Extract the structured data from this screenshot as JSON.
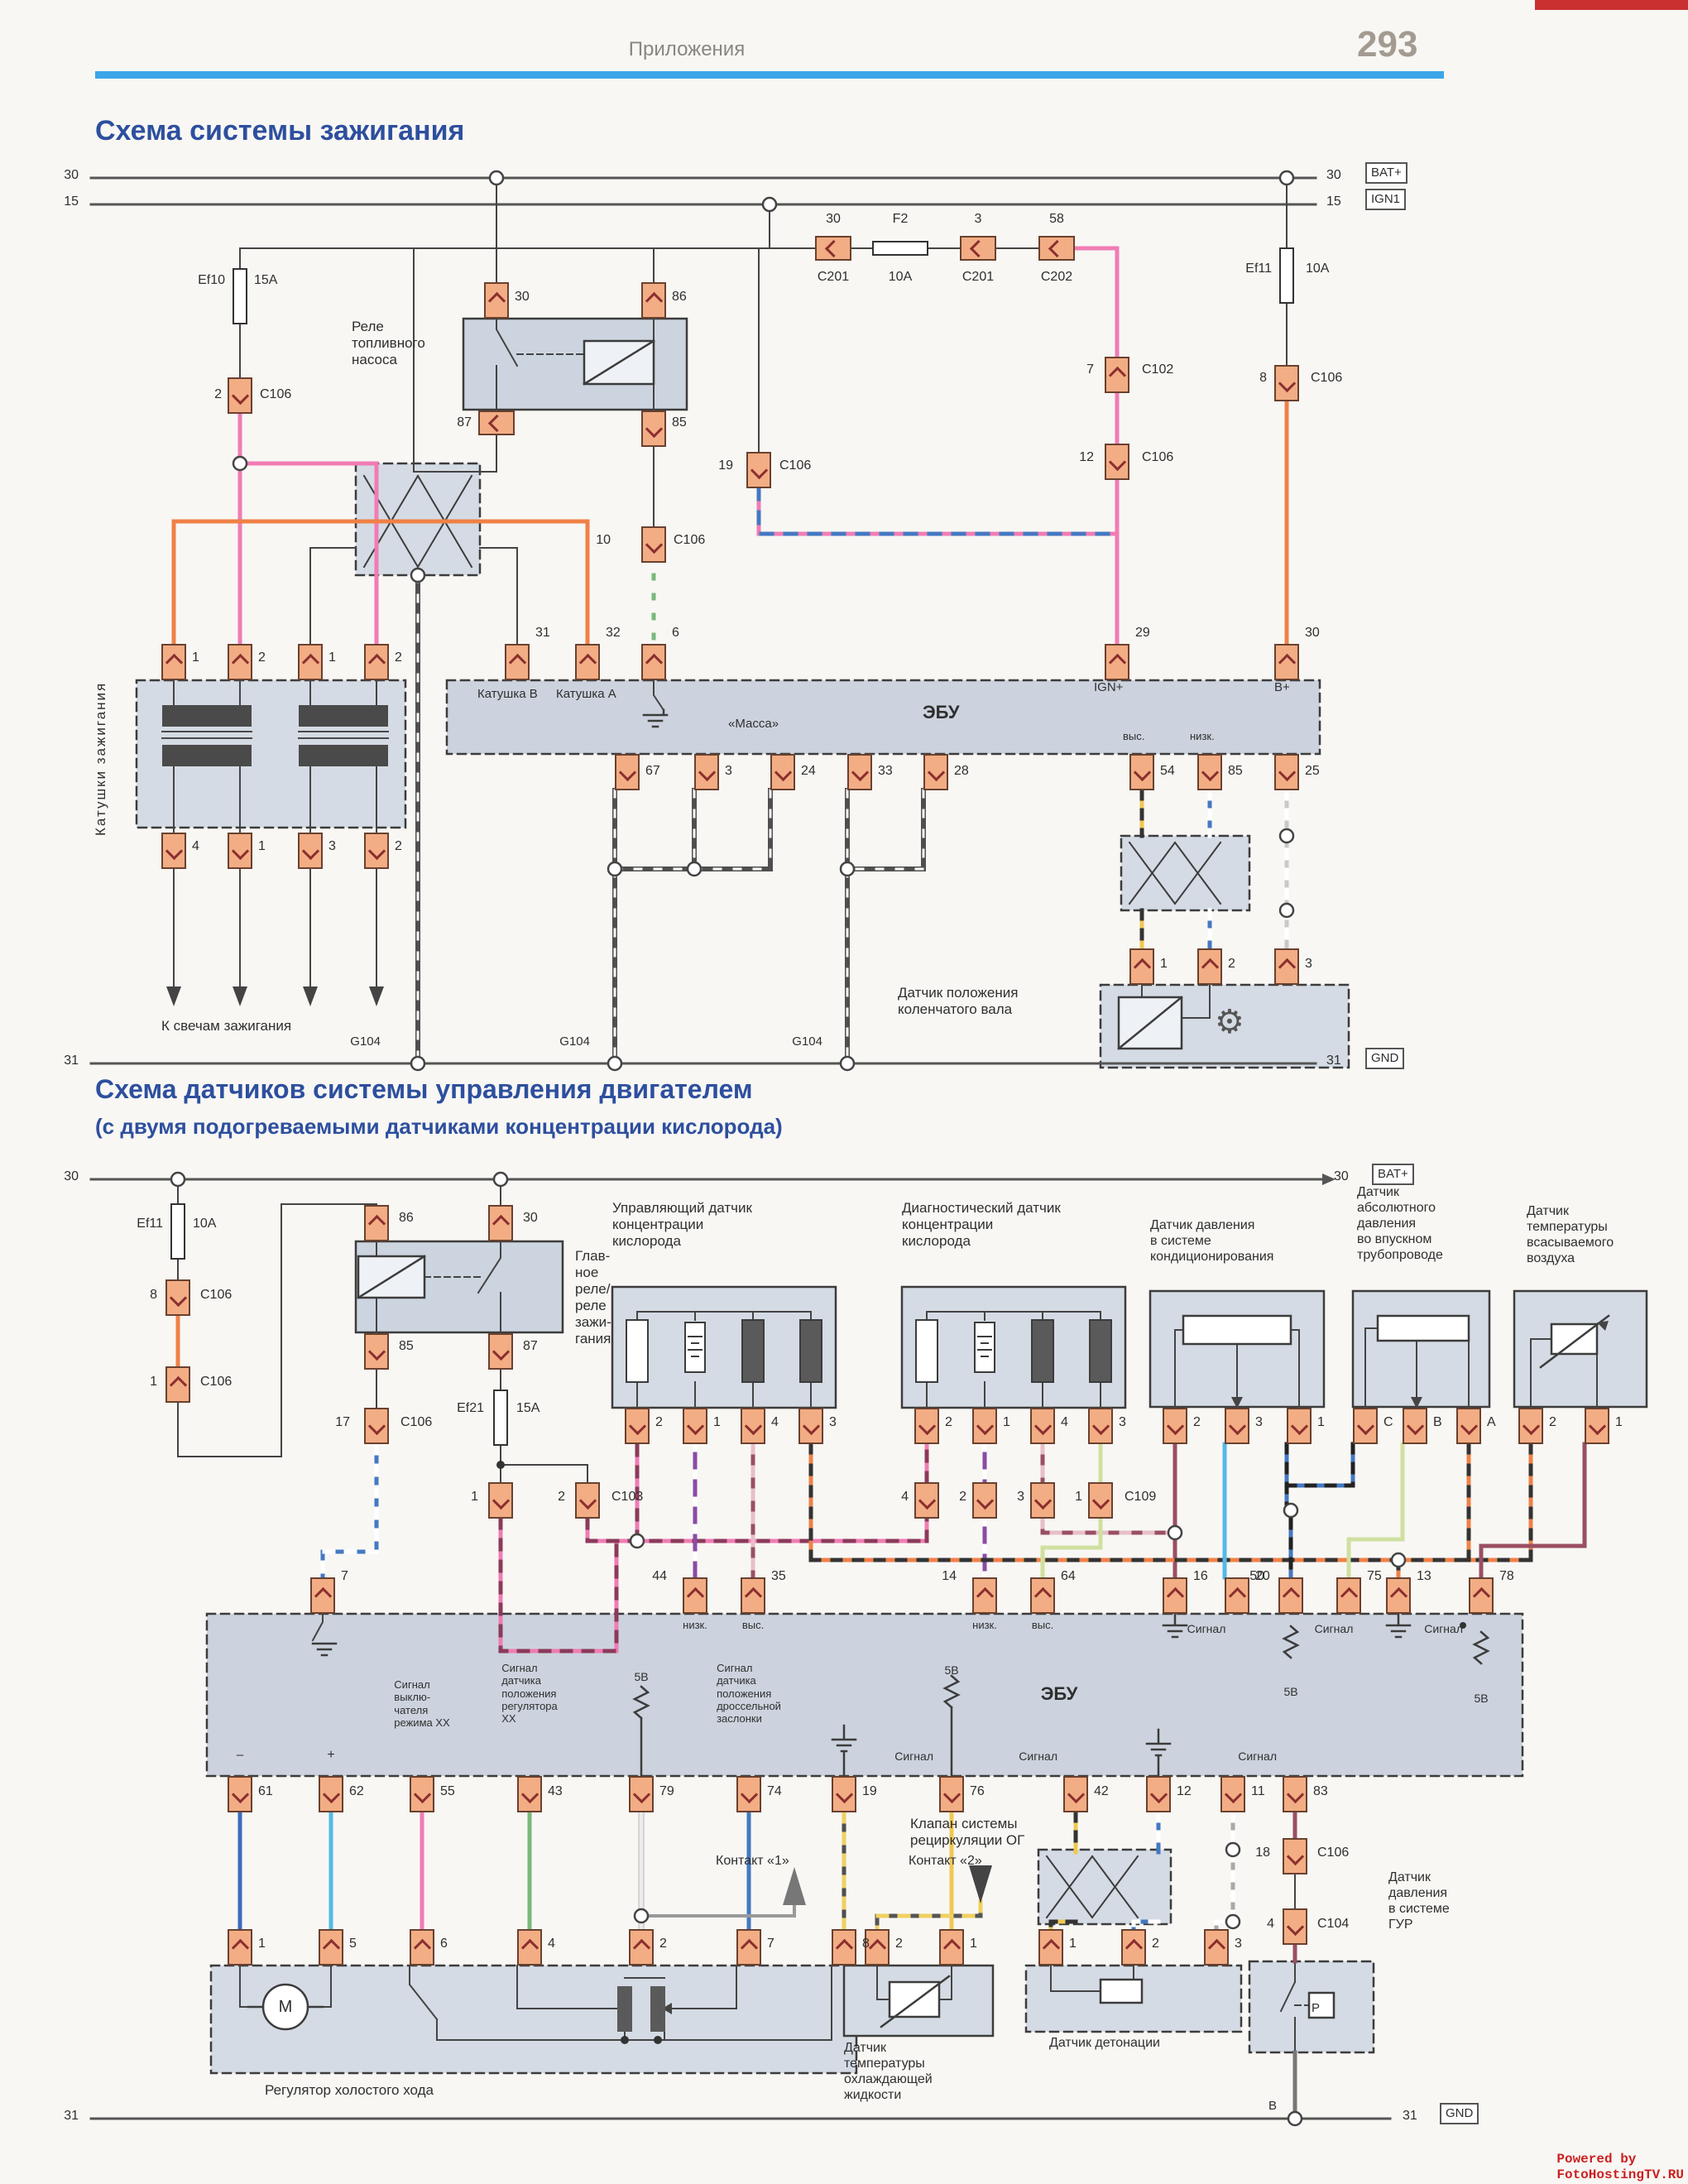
{
  "header": {
    "breadcrumb": "Приложения",
    "page_number": "293"
  },
  "diagram1": {
    "title": "Схема системы зажигания"
  },
  "diagram2": {
    "title": "Схема датчиков системы управления двигателем",
    "subtitle": "(с двумя подогреваемыми датчиками концентрации кислорода)"
  },
  "watermark": "Powered by FotoHostingTV.RU",
  "colors": {
    "accent_blue": "#2d4f9e",
    "rule_blue": "#3aa6e8",
    "pin_fill": "#f3ad84",
    "wire_pink": "#f07cb4",
    "wire_orange": "#ef8147",
    "wire_green": "#79b97c",
    "wire_blue": "#4478c2",
    "wire_cyan": "#54b9e6",
    "wire_purple": "#8a4ba5",
    "wire_maroon": "#9a4f63",
    "wire_yellow": "#f0c851",
    "wire_palegreen": "#cfe0a0"
  },
  "texts": [
    [
      830,
      46,
      "Приложения",
      "s24 gray c"
    ],
    [
      115,
      138,
      "Схема системы зажигания",
      "s34 blue b"
    ],
    [
      115,
      1298,
      "Схема датчиков системы управления двигателем",
      "s32 blue b"
    ],
    [
      115,
      1346,
      "(с двумя подогреваемыми датчиками концентрации кислорода)",
      "s26 blue b"
    ],
    [
      95,
      203,
      "30",
      "s16 r"
    ],
    [
      95,
      235,
      "15",
      "s16 r"
    ],
    [
      1603,
      203,
      "30",
      "s16"
    ],
    [
      1603,
      235,
      "15",
      "s16"
    ],
    [
      95,
      1273,
      "31",
      "s16 r"
    ],
    [
      1603,
      1273,
      "31",
      "s16"
    ],
    [
      272,
      330,
      "Ef10",
      "s16 r"
    ],
    [
      307,
      330,
      "15A",
      "s16"
    ],
    [
      268,
      468,
      "2",
      "s16 r"
    ],
    [
      314,
      468,
      "C106",
      "s16"
    ],
    [
      425,
      385,
      "Реле\nтопливного\nнасоса",
      "s17"
    ],
    [
      622,
      350,
      "30",
      "s16"
    ],
    [
      812,
      350,
      "86",
      "s16"
    ],
    [
      570,
      502,
      "87",
      "s16 r"
    ],
    [
      812,
      502,
      "85",
      "s16"
    ],
    [
      738,
      644,
      "10",
      "s16 r"
    ],
    [
      814,
      644,
      "C106",
      "s16"
    ],
    [
      886,
      554,
      "19",
      "s16 r"
    ],
    [
      942,
      554,
      "C106",
      "s16"
    ],
    [
      1007,
      256,
      "30",
      "s16 c"
    ],
    [
      1007,
      326,
      "C201",
      "s16 c"
    ],
    [
      1088,
      256,
      "F2",
      "s16 c"
    ],
    [
      1088,
      326,
      "10A",
      "s16 c"
    ],
    [
      1182,
      256,
      "3",
      "s16 c"
    ],
    [
      1182,
      326,
      "C201",
      "s16 c"
    ],
    [
      1277,
      256,
      "58",
      "s16 c"
    ],
    [
      1277,
      326,
      "C202",
      "s16 c"
    ],
    [
      1322,
      438,
      "7",
      "s16 r"
    ],
    [
      1380,
      438,
      "C102",
      "s16"
    ],
    [
      1322,
      544,
      "12",
      "s16 r"
    ],
    [
      1380,
      544,
      "C106",
      "s16"
    ],
    [
      1537,
      316,
      "Ef11",
      "s16 r"
    ],
    [
      1578,
      316,
      "10A",
      "s16"
    ],
    [
      1531,
      448,
      "8",
      "s16 r"
    ],
    [
      1584,
      448,
      "C106",
      "s16"
    ],
    [
      232,
      786,
      "1",
      "s16"
    ],
    [
      312,
      786,
      "2",
      "s16"
    ],
    [
      397,
      786,
      "1",
      "s16"
    ],
    [
      477,
      786,
      "2",
      "s16"
    ],
    [
      232,
      1014,
      "4",
      "s16"
    ],
    [
      312,
      1014,
      "1",
      "s16"
    ],
    [
      397,
      1014,
      "3",
      "s16"
    ],
    [
      477,
      1014,
      "2",
      "s16"
    ],
    [
      195,
      1230,
      "К свечам зажигания",
      "s17"
    ],
    [
      112,
      1010,
      "Катушки зажигания",
      "s17 rot"
    ],
    [
      647,
      756,
      "31",
      "s16"
    ],
    [
      732,
      756,
      "32",
      "s16"
    ],
    [
      812,
      756,
      "6",
      "s16"
    ],
    [
      1372,
      756,
      "29",
      "s16"
    ],
    [
      1577,
      756,
      "30",
      "s16"
    ],
    [
      577,
      830,
      "Катушка B",
      "s15"
    ],
    [
      672,
      830,
      "Катушка A",
      "s15"
    ],
    [
      880,
      866,
      "«Масса»",
      "s15"
    ],
    [
      1115,
      848,
      "ЭБУ",
      "s22 b"
    ],
    [
      1322,
      822,
      "IGN+",
      "s15"
    ],
    [
      1540,
      822,
      "B+",
      "s15"
    ],
    [
      1357,
      882,
      "выс.",
      "s13"
    ],
    [
      1438,
      882,
      "низк.",
      "s13"
    ],
    [
      780,
      923,
      "67",
      "s16"
    ],
    [
      876,
      923,
      "3",
      "s16"
    ],
    [
      968,
      923,
      "24",
      "s16"
    ],
    [
      1061,
      923,
      "33",
      "s16"
    ],
    [
      1153,
      923,
      "28",
      "s16"
    ],
    [
      1402,
      923,
      "54",
      "s16"
    ],
    [
      1484,
      923,
      "85",
      "s16"
    ],
    [
      1577,
      923,
      "25",
      "s16"
    ],
    [
      1402,
      1156,
      "1",
      "s16"
    ],
    [
      1484,
      1156,
      "2",
      "s16"
    ],
    [
      1577,
      1156,
      "3",
      "s16"
    ],
    [
      1085,
      1190,
      "Датчик положения\nколенчатого вала",
      "s17"
    ],
    [
      1468,
      1212,
      "⚙",
      "s40 mid"
    ],
    [
      460,
      1250,
      "G104",
      "s15 r"
    ],
    [
      713,
      1250,
      "G104",
      "s15 r"
    ],
    [
      994,
      1250,
      "G104",
      "s15 r"
    ],
    [
      95,
      1413,
      "30",
      "s16 r"
    ],
    [
      1612,
      1413,
      "30",
      "s16"
    ],
    [
      95,
      2548,
      "31",
      "s16 r"
    ],
    [
      1695,
      2548,
      "31",
      "s16"
    ],
    [
      197,
      1470,
      "Ef11",
      "s16 r"
    ],
    [
      233,
      1470,
      "10A",
      "s16"
    ],
    [
      190,
      1556,
      "8",
      "s16 r"
    ],
    [
      242,
      1556,
      "C106",
      "s16"
    ],
    [
      190,
      1661,
      "1",
      "s16 r"
    ],
    [
      242,
      1661,
      "C106",
      "s16"
    ],
    [
      482,
      1463,
      "86",
      "s16"
    ],
    [
      632,
      1463,
      "30",
      "s16"
    ],
    [
      482,
      1618,
      "85",
      "s16"
    ],
    [
      632,
      1618,
      "87",
      "s16"
    ],
    [
      695,
      1508,
      "Глав-\nное\nреле/\nреле\nзажи-\nгания",
      "s17"
    ],
    [
      585,
      1693,
      "Ef21",
      "s16 r"
    ],
    [
      624,
      1693,
      "15A",
      "s16"
    ],
    [
      423,
      1710,
      "17",
      "s16 r"
    ],
    [
      484,
      1710,
      "C106",
      "s16"
    ],
    [
      578,
      1800,
      "1",
      "s16 r"
    ],
    [
      683,
      1800,
      "2",
      "s16 r"
    ],
    [
      739,
      1800,
      "C103",
      "s16"
    ],
    [
      740,
      1450,
      "Управляющий датчик\nконцентрации\nкислорода",
      "s17"
    ],
    [
      1090,
      1450,
      "Диагностический датчик\nконцентрации\nкислорода",
      "s17"
    ],
    [
      792,
      1710,
      "2",
      "s16"
    ],
    [
      862,
      1710,
      "1",
      "s16"
    ],
    [
      932,
      1710,
      "4",
      "s16"
    ],
    [
      1002,
      1710,
      "3",
      "s16"
    ],
    [
      1142,
      1710,
      "2",
      "s16"
    ],
    [
      1212,
      1710,
      "1",
      "s16"
    ],
    [
      1282,
      1710,
      "4",
      "s16"
    ],
    [
      1352,
      1710,
      "3",
      "s16"
    ],
    [
      1098,
      1800,
      "4",
      "s16 r"
    ],
    [
      1168,
      1800,
      "2",
      "s16 r"
    ],
    [
      1238,
      1800,
      "3",
      "s16 r"
    ],
    [
      1308,
      1800,
      "1",
      "s16 r"
    ],
    [
      1359,
      1800,
      "C109",
      "s16"
    ],
    [
      1390,
      1472,
      "Датчик давления\nв системе\nкондиционирования",
      "s16"
    ],
    [
      1640,
      1432,
      "Датчик\nабсолютного\nдавления\nво впускном\nтрубопроводе",
      "s16"
    ],
    [
      1845,
      1455,
      "Датчик\nтемпературы\nвсасываемого\nвоздуха",
      "s16"
    ],
    [
      1442,
      1710,
      "2",
      "s16"
    ],
    [
      1517,
      1710,
      "3",
      "s16"
    ],
    [
      1592,
      1710,
      "1",
      "s16"
    ],
    [
      1672,
      1710,
      "C",
      "s16"
    ],
    [
      1732,
      1710,
      "B",
      "s16"
    ],
    [
      1797,
      1710,
      "A",
      "s16"
    ],
    [
      1872,
      1710,
      "2",
      "s16"
    ],
    [
      1952,
      1710,
      "1",
      "s16"
    ],
    [
      412,
      1896,
      "7",
      "s16"
    ],
    [
      806,
      1896,
      "44",
      "s16 r"
    ],
    [
      932,
      1896,
      "35",
      "s16"
    ],
    [
      1156,
      1896,
      "14",
      "s16 r"
    ],
    [
      1282,
      1896,
      "64",
      "s16"
    ],
    [
      1442,
      1896,
      "16",
      "s16"
    ],
    [
      1517,
      1896,
      "20",
      "s16"
    ],
    [
      1528,
      1896,
      "50",
      "s16 r"
    ],
    [
      1652,
      1896,
      "75",
      "s16"
    ],
    [
      1712,
      1896,
      "13",
      "s16"
    ],
    [
      1812,
      1896,
      "78",
      "s16"
    ],
    [
      840,
      1956,
      "низк.",
      "s13 c"
    ],
    [
      910,
      1956,
      "выс.",
      "s13 c"
    ],
    [
      1190,
      1956,
      "низк.",
      "s13 c"
    ],
    [
      1260,
      1956,
      "выс.",
      "s13 c"
    ],
    [
      1458,
      1960,
      "Сигнал",
      "s14 c"
    ],
    [
      1560,
      2036,
      "5В",
      "s14 c"
    ],
    [
      1612,
      1960,
      "Сигнал",
      "s14 c"
    ],
    [
      1768,
      1960,
      "Сигнал",
      "s14 r"
    ],
    [
      1790,
      2044,
      "5В",
      "s14 c"
    ],
    [
      1280,
      2034,
      "ЭБУ",
      "s22 b c"
    ],
    [
      290,
      2112,
      "–",
      "s18 c"
    ],
    [
      400,
      2112,
      "+",
      "s16 c"
    ],
    [
      510,
      2028,
      "Сигнал\nвыклю-\nчателя\nрежима XX",
      "s13 c"
    ],
    [
      640,
      2008,
      "Сигнал\nдатчика\nположения\nрегулятора\nXX",
      "s13 c"
    ],
    [
      775,
      2018,
      "5В",
      "s14 c"
    ],
    [
      905,
      2008,
      "Сигнал\nдатчика\nположения\nдроссельной\nзаслонки",
      "s13 c"
    ],
    [
      1150,
      2010,
      "5В",
      "s14 c"
    ],
    [
      1128,
      2114,
      "Сигнал",
      "s14 r"
    ],
    [
      1278,
      2114,
      "Сигнал",
      "s14 r"
    ],
    [
      1543,
      2114,
      "Сигнал",
      "s14 r"
    ],
    [
      312,
      2156,
      "61",
      "s16"
    ],
    [
      422,
      2156,
      "62",
      "s16"
    ],
    [
      532,
      2156,
      "55",
      "s16"
    ],
    [
      662,
      2156,
      "43",
      "s16"
    ],
    [
      797,
      2156,
      "79",
      "s16"
    ],
    [
      927,
      2156,
      "74",
      "s16"
    ],
    [
      1042,
      2156,
      "19",
      "s16"
    ],
    [
      1172,
      2156,
      "76",
      "s16"
    ],
    [
      1322,
      2156,
      "42",
      "s16"
    ],
    [
      1422,
      2156,
      "12",
      "s16"
    ],
    [
      1512,
      2156,
      "11",
      "s16"
    ],
    [
      1587,
      2156,
      "83",
      "s16"
    ],
    [
      1100,
      2194,
      "Клапан системы\nрециркуляции ОГ",
      "s17"
    ],
    [
      865,
      2240,
      "Контакт «1»",
      "s16"
    ],
    [
      1098,
      2240,
      "Контакт «2»",
      "s16"
    ],
    [
      312,
      2340,
      "1",
      "s16"
    ],
    [
      422,
      2340,
      "5",
      "s16"
    ],
    [
      532,
      2340,
      "6",
      "s16"
    ],
    [
      662,
      2340,
      "4",
      "s16"
    ],
    [
      797,
      2340,
      "2",
      "s16"
    ],
    [
      927,
      2340,
      "7",
      "s16"
    ],
    [
      1042,
      2340,
      "8",
      "s16"
    ],
    [
      345,
      2414,
      "M",
      "s20 c"
    ],
    [
      320,
      2516,
      "Регулятор холостого хода",
      "s17"
    ],
    [
      1082,
      2340,
      "2",
      "s16"
    ],
    [
      1172,
      2340,
      "1",
      "s16"
    ],
    [
      1020,
      2466,
      "Датчик\nтемпературы\nохлаждающей\nжидкости",
      "s16"
    ],
    [
      1292,
      2340,
      "1",
      "s16"
    ],
    [
      1392,
      2340,
      "2",
      "s16"
    ],
    [
      1492,
      2340,
      "3",
      "s16"
    ],
    [
      1268,
      2460,
      "Датчик детонации",
      "s16"
    ],
    [
      1535,
      2230,
      "18",
      "s16 r"
    ],
    [
      1592,
      2230,
      "C106",
      "s16"
    ],
    [
      1540,
      2316,
      "4",
      "s16 r"
    ],
    [
      1592,
      2316,
      "C104",
      "s16"
    ],
    [
      1590,
      2418,
      "P",
      "s15 c"
    ],
    [
      1678,
      2260,
      "Датчик\nдавления\nв системе\nГУР",
      "s16"
    ],
    [
      1543,
      2536,
      "B",
      "s15 r"
    ],
    [
      2035,
      2600,
      "Powered by FotoHostingTV.RU",
      "s16 red b mono r"
    ]
  ],
  "pins": [
    [
      585,
      341,
      "u"
    ],
    [
      775,
      341,
      "u"
    ],
    [
      578,
      496,
      "h"
    ],
    [
      775,
      496,
      "d"
    ],
    [
      275,
      456,
      "d"
    ],
    [
      775,
      636,
      "d"
    ],
    [
      902,
      546,
      "d"
    ],
    [
      985,
      285,
      "h"
    ],
    [
      1160,
      285,
      "h"
    ],
    [
      1255,
      285,
      "h"
    ],
    [
      1335,
      431,
      "u"
    ],
    [
      1335,
      536,
      "d"
    ],
    [
      1540,
      441,
      "d"
    ],
    [
      195,
      778,
      "u"
    ],
    [
      275,
      778,
      "u"
    ],
    [
      360,
      778,
      "u"
    ],
    [
      440,
      778,
      "u"
    ],
    [
      195,
      1006,
      "d"
    ],
    [
      275,
      1006,
      "d"
    ],
    [
      360,
      1006,
      "d"
    ],
    [
      440,
      1006,
      "d"
    ],
    [
      610,
      778,
      "u"
    ],
    [
      695,
      778,
      "u"
    ],
    [
      775,
      778,
      "u"
    ],
    [
      1335,
      778,
      "u"
    ],
    [
      1540,
      778,
      "u"
    ],
    [
      743,
      911,
      "d"
    ],
    [
      839,
      911,
      "d"
    ],
    [
      931,
      911,
      "d"
    ],
    [
      1024,
      911,
      "d"
    ],
    [
      1116,
      911,
      "d"
    ],
    [
      1365,
      911,
      "d"
    ],
    [
      1447,
      911,
      "d"
    ],
    [
      1540,
      911,
      "d"
    ],
    [
      1365,
      1146,
      "u"
    ],
    [
      1447,
      1146,
      "u"
    ],
    [
      1540,
      1146,
      "u"
    ],
    [
      440,
      1456,
      "u"
    ],
    [
      590,
      1456,
      "u"
    ],
    [
      440,
      1611,
      "d"
    ],
    [
      590,
      1611,
      "d"
    ],
    [
      200,
      1546,
      "d"
    ],
    [
      200,
      1651,
      "u"
    ],
    [
      440,
      1701,
      "d"
    ],
    [
      590,
      1791,
      "d"
    ],
    [
      695,
      1791,
      "d"
    ],
    [
      755,
      1701,
      "d"
    ],
    [
      825,
      1701,
      "d"
    ],
    [
      895,
      1701,
      "d"
    ],
    [
      965,
      1701,
      "d"
    ],
    [
      1105,
      1701,
      "d"
    ],
    [
      1175,
      1701,
      "d"
    ],
    [
      1245,
      1701,
      "d"
    ],
    [
      1315,
      1701,
      "d"
    ],
    [
      1105,
      1791,
      "d"
    ],
    [
      1175,
      1791,
      "d"
    ],
    [
      1245,
      1791,
      "d"
    ],
    [
      1315,
      1791,
      "d"
    ],
    [
      1405,
      1701,
      "d"
    ],
    [
      1480,
      1701,
      "d"
    ],
    [
      1555,
      1701,
      "d"
    ],
    [
      1635,
      1701,
      "d"
    ],
    [
      1695,
      1701,
      "d"
    ],
    [
      1760,
      1701,
      "d"
    ],
    [
      1835,
      1701,
      "d"
    ],
    [
      1915,
      1701,
      "d"
    ],
    [
      375,
      1906,
      "u"
    ],
    [
      825,
      1906,
      "u"
    ],
    [
      895,
      1906,
      "u"
    ],
    [
      1175,
      1906,
      "u"
    ],
    [
      1245,
      1906,
      "u"
    ],
    [
      1405,
      1906,
      "u"
    ],
    [
      1480,
      1906,
      "u"
    ],
    [
      1545,
      1906,
      "u"
    ],
    [
      1615,
      1906,
      "u"
    ],
    [
      1675,
      1906,
      "u"
    ],
    [
      1775,
      1906,
      "u"
    ],
    [
      275,
      2146,
      "d"
    ],
    [
      385,
      2146,
      "d"
    ],
    [
      495,
      2146,
      "d"
    ],
    [
      625,
      2146,
      "d"
    ],
    [
      760,
      2146,
      "d"
    ],
    [
      890,
      2146,
      "d"
    ],
    [
      1005,
      2146,
      "d"
    ],
    [
      1135,
      2146,
      "d"
    ],
    [
      1285,
      2146,
      "d"
    ],
    [
      1385,
      2146,
      "d"
    ],
    [
      1475,
      2146,
      "d"
    ],
    [
      1550,
      2146,
      "d"
    ],
    [
      275,
      2331,
      "u"
    ],
    [
      385,
      2331,
      "u"
    ],
    [
      495,
      2331,
      "u"
    ],
    [
      625,
      2331,
      "u"
    ],
    [
      760,
      2331,
      "u"
    ],
    [
      890,
      2331,
      "u"
    ],
    [
      1005,
      2331,
      "u"
    ],
    [
      1045,
      2331,
      "u"
    ],
    [
      1135,
      2331,
      "u"
    ],
    [
      1255,
      2331,
      "u"
    ],
    [
      1355,
      2331,
      "u"
    ],
    [
      1455,
      2331,
      "u"
    ],
    [
      1550,
      2221,
      "d"
    ],
    [
      1550,
      2306,
      "d"
    ]
  ]
}
